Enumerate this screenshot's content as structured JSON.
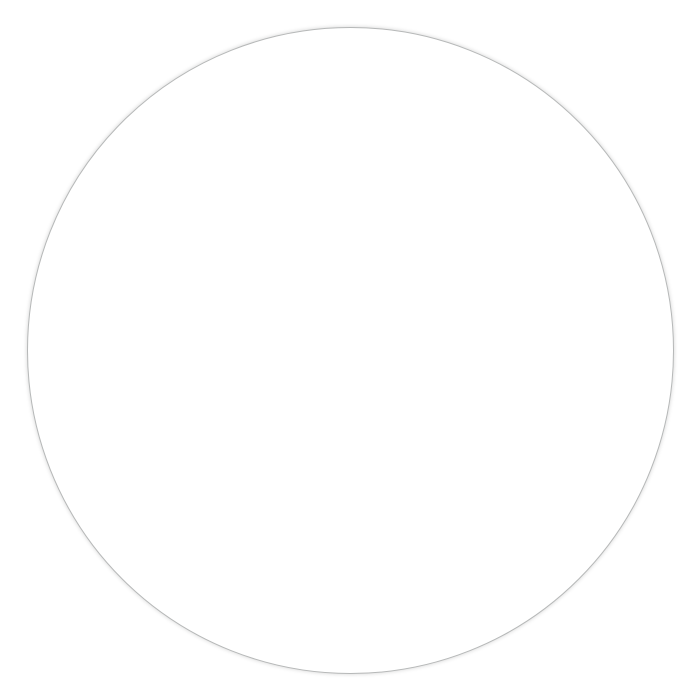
{
  "watermarks": {
    "left_week_number": "11",
    "right_week_number_partial": "1"
  },
  "left_column": {
    "rows": [
      {
        "day": "11",
        "weekday": "MI",
        "day_of_year": "70",
        "shade": "none"
      },
      {
        "day": "12",
        "weekday": "DO",
        "day_of_year": "71",
        "shade": "none"
      },
      {
        "day": "13",
        "weekday": "FR",
        "day_of_year": "72",
        "shade": "none"
      },
      {
        "day": "14",
        "weekday": "SA",
        "day_of_year": "73",
        "shade": "light"
      },
      {
        "day": "15",
        "weekday": "SO",
        "day_of_year": "74",
        "shade": "dark"
      }
    ]
  },
  "right_column": {
    "rows": [
      {
        "day": "11",
        "weekday": "SA",
        "day_of_year": "",
        "shade": "light"
      },
      {
        "day": "12",
        "weekday": "SO",
        "day_of_year": "",
        "shade": "dark"
      },
      {
        "day": "13",
        "weekday": "MO",
        "day_of_year": "",
        "shade": "none"
      },
      {
        "day": "14",
        "weekday": "DI",
        "day_of_year": "",
        "shade": "none"
      },
      {
        "day": "15",
        "weekday": "MI",
        "day_of_year": "",
        "shade": "none"
      }
    ]
  },
  "colors": {
    "row_light": "#ebebed",
    "row_dark": "#b3b3b5",
    "grid_line": "#1a1a1a",
    "watermark": "#e9e9eb",
    "day_text": "#1c1c1e",
    "text_on_dark": "#ffffff"
  }
}
